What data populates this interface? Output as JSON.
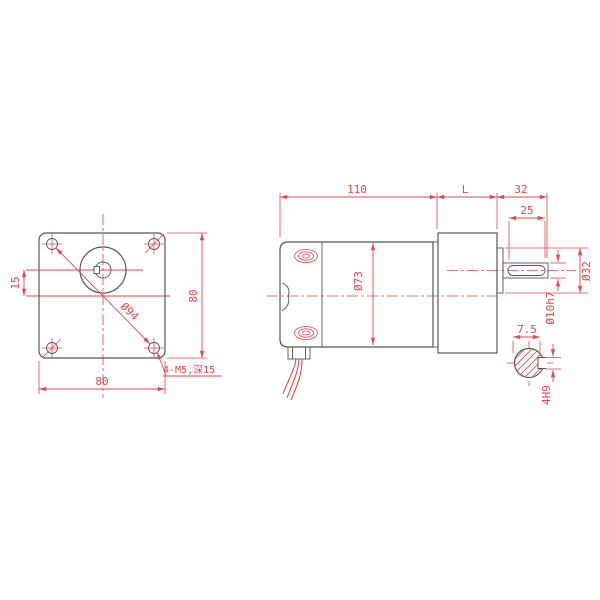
{
  "title": "gear-motor dimensional drawing",
  "colors": {
    "dimension_red": "#e14a4a",
    "outline_gray": "#565656"
  },
  "front_view": {
    "width_label": "80",
    "height_label": "80",
    "shaft_offset_label": "15",
    "bolt_circle_label": "Ø94",
    "mounting_holes_label": "4-M5,深15"
  },
  "side_view": {
    "motor_length_label": "110",
    "gearbox_length_label": "L",
    "shaft_length_label": "32",
    "keyway_length_label": "25",
    "motor_diameter_label": "Ø73",
    "pilot_diameter_label": "Ø32",
    "shaft_diameter_label": "Ø10h7"
  },
  "shaft_section": {
    "flat_height_label": "7.5",
    "keyway_width_label": "4H9"
  }
}
